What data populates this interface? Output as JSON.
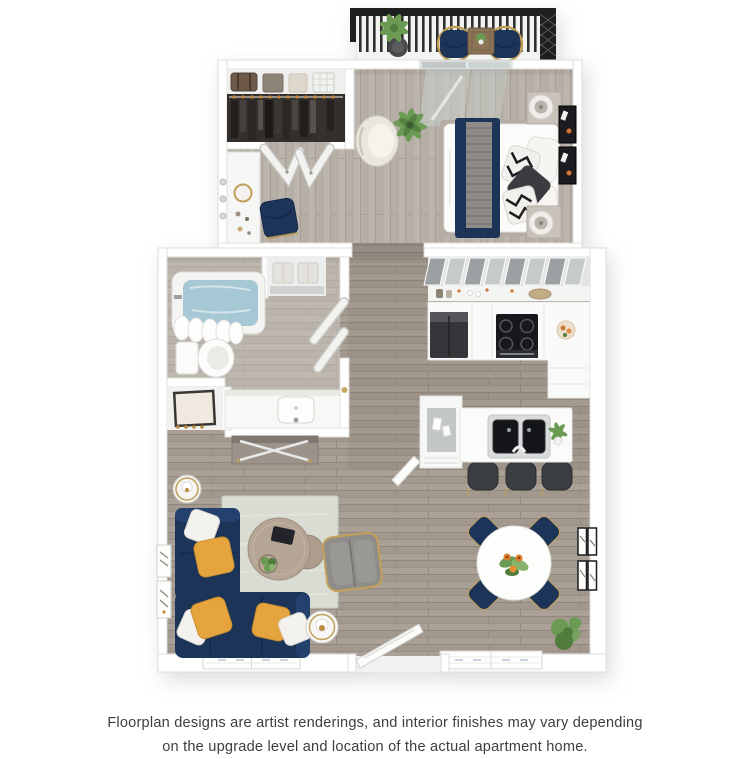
{
  "page": {
    "background": "#ffffff"
  },
  "disclaimer": {
    "line1": "Floorplan designs are artist renderings, and interior finishes may vary depending",
    "line2": "on the upgrade level and location of the actual apartment home."
  },
  "floorplan": {
    "alt": "3D top-down rendering of a one-bedroom apartment with balcony",
    "colors": {
      "c-navy": "#1d3459",
      "c-yellow": "#e5a43e",
      "c-gold": "#c2a05a",
      "c-rug": "#d8dcd3",
      "c-water": "#a6c8d5",
      "c-stool": "#3a3d41",
      "c-green": "#6b9a53",
      "c-green2": "#517c3e",
      "c-rail": "#1f1f1f",
      "c-frame": "#1b1b20",
      "c-orange": "#d2763a"
    },
    "rooms": [
      "balcony",
      "bedroom",
      "closet",
      "bathroom",
      "linen-closet",
      "hallway",
      "kitchen",
      "living-room",
      "dining-area",
      "entry"
    ],
    "furniture": {
      "balcony": [
        "railing",
        "potted-plant",
        "two-navy-chairs",
        "side-table"
      ],
      "bedroom": [
        "queen-bed-navy-runner",
        "two-nightstand-lamps",
        "accent-chair",
        "palm-plant",
        "sliding-glass-door",
        "wall-art"
      ],
      "closet": [
        "hanging-clothes",
        "storage-boxes",
        "bifold-doors",
        "vanity-desk",
        "navy-desk-chair"
      ],
      "bathroom": [
        "bathtub",
        "shower-curtain",
        "towel-shelf",
        "toilet",
        "vanity-sink",
        "door"
      ],
      "kitchen": [
        "upper-cabinets",
        "refrigerator",
        "cooktop-stove",
        "l-counter",
        "island-double-sink",
        "three-bar-stools",
        "pantry-cabinet"
      ],
      "living-room": [
        "navy-sectional-sofa",
        "throw-pillows",
        "area-rug",
        "nesting-coffee-tables",
        "gray-armchair",
        "side-tables",
        "wall-frames"
      ],
      "dining-area": [
        "round-table",
        "four-navy-chairs",
        "flower-centerpiece",
        "gallery-frames",
        "corner-plant"
      ],
      "entry": [
        "open-door",
        "windows"
      ]
    }
  }
}
